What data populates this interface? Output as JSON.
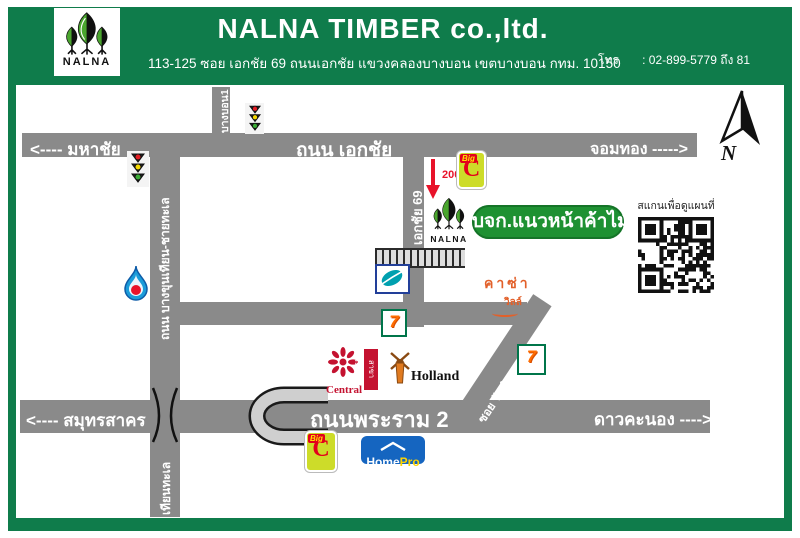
{
  "colors": {
    "header-green": "#0f7c4b",
    "sign-green": "#1e9132",
    "road-gray": "#8a8a8a",
    "red": "#e8132a",
    "casa-orange": "#e2602a",
    "bigc-lime": "#cddc29",
    "bigc-red": "#e3001b",
    "homepro-blue": "#1565c0",
    "seven-green": "#00754a",
    "central-red": "#c41230",
    "lotus-teal": "#00a0af",
    "ptt-blue": "#1b9cd9"
  },
  "header": {
    "logo_text": "NALNA",
    "title": "NALNA TIMBER co.,ltd.",
    "address": "113-125 ซอย เอกชัย 69 ถนนเอกชัย แขวงคลองบางบอน เขตบางบอน กทม. 10150",
    "contact": {
      "lines": [
        "โทร       : 02-899-5779 ถึง 81",
        "โทรสาร :  02-899-5381",
        "E-mail : Nalna@hotmail.co.th",
        "Line ID: @ato2935z"
      ]
    }
  },
  "map": {
    "roads": {
      "ekkachai": {
        "label": "ถนน เอกชัย",
        "west": "<----  มหาชัย",
        "east": "จอมทอง ----->"
      },
      "bangbon1": {
        "label": "บางบอน1"
      },
      "bangkhunthian": {
        "label": "ถนน บางขุนเทียน-ชายทะเล",
        "south_label": "เทียนทะเล"
      },
      "ekkachai69": {
        "label": "เอกชัย 69"
      },
      "watkamphaeng": {
        "label": "ซอย วัดกำแพง"
      },
      "rama2": {
        "label": "ถนนพระราม 2",
        "west": "<---- สมุทรสาคร",
        "east": "ดาวคะนอง ---->"
      }
    },
    "destination_sign": "บจก.แนวหน้าค้าไม้",
    "distance_note": "200m.",
    "casa_ville": {
      "line1": "คาซ่า",
      "line2": "วิลล์"
    },
    "qr_caption": "สแกนเพื่อดูแผนที่",
    "compass_label": "N",
    "landmarks": {
      "bigc": {
        "big": "Big",
        "c": "C"
      },
      "seven": {
        "glyph": "7"
      },
      "central": {
        "name": "Central",
        "branch": "สาขา พระราม 2"
      },
      "holland": {
        "name": "Holland"
      },
      "homepro": {
        "home": "Home",
        "pro": "Pro"
      },
      "nalna": {
        "name": "NALNA"
      }
    }
  }
}
